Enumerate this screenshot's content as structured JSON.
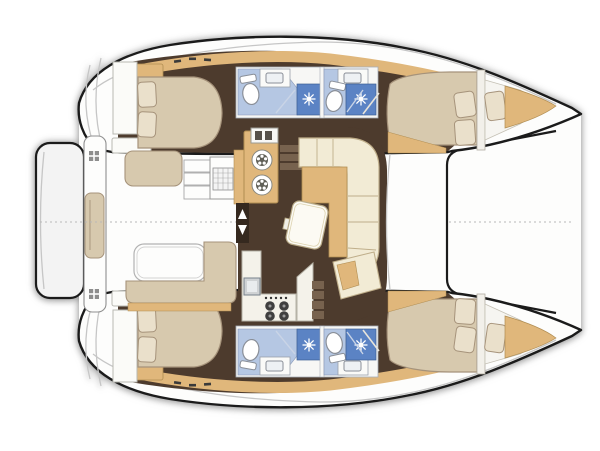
{
  "meta": {
    "type": "floor-plan",
    "subject": "sailing catamaran interior and deck layout",
    "view": "overhead plan, bows to the right",
    "cabins": 4,
    "heads": 4
  },
  "colors": {
    "background": "#ffffff",
    "outline": "#1b1b1b",
    "hull_white": "#fdfdfc",
    "deck_line": "#c6c6c6",
    "floor_dark": "#4d3b2d",
    "wood": "#e0b77b",
    "wood_dark": "#b08d52",
    "bed": "#d7c9ae",
    "pillow": "#eae0cb",
    "bed_outline": "#a6937b",
    "sofa": "#f2ebd5",
    "sofa_outline": "#bfae8a",
    "counter_white": "#f4f2ea",
    "bath_floor": "#b5c7e3",
    "shower_blue": "#5b83c4",
    "fixture_outline": "#8a8f98",
    "platform": "#f3f3f3",
    "step_wood": "#77624e",
    "door_dark": "#35291f",
    "cleat_dark": "#3a3a3a"
  },
  "rooms": {
    "port_hull": [
      "aft cabin double berth",
      "aft head with shower",
      "forward head with shower",
      "forward cabin double berth",
      "forepeak berth"
    ],
    "starboard_hull": [
      "aft cabin double berth",
      "aft head with shower",
      "forward head with shower",
      "forward cabin double berth",
      "forepeak berth"
    ],
    "center": [
      "salon with L-sofa and table",
      "galley with twin burners and sink",
      "stove with oven and nav desk",
      "companionway entry",
      "cockpit with table and benches",
      "transom bench",
      "aft swim platform",
      "foredeck and trampoline beam"
    ]
  },
  "icons": {
    "shower_spray": "starburst",
    "burner": "daisy-ring",
    "hatch": "dot-grid",
    "entry": "up-down-arrows"
  }
}
